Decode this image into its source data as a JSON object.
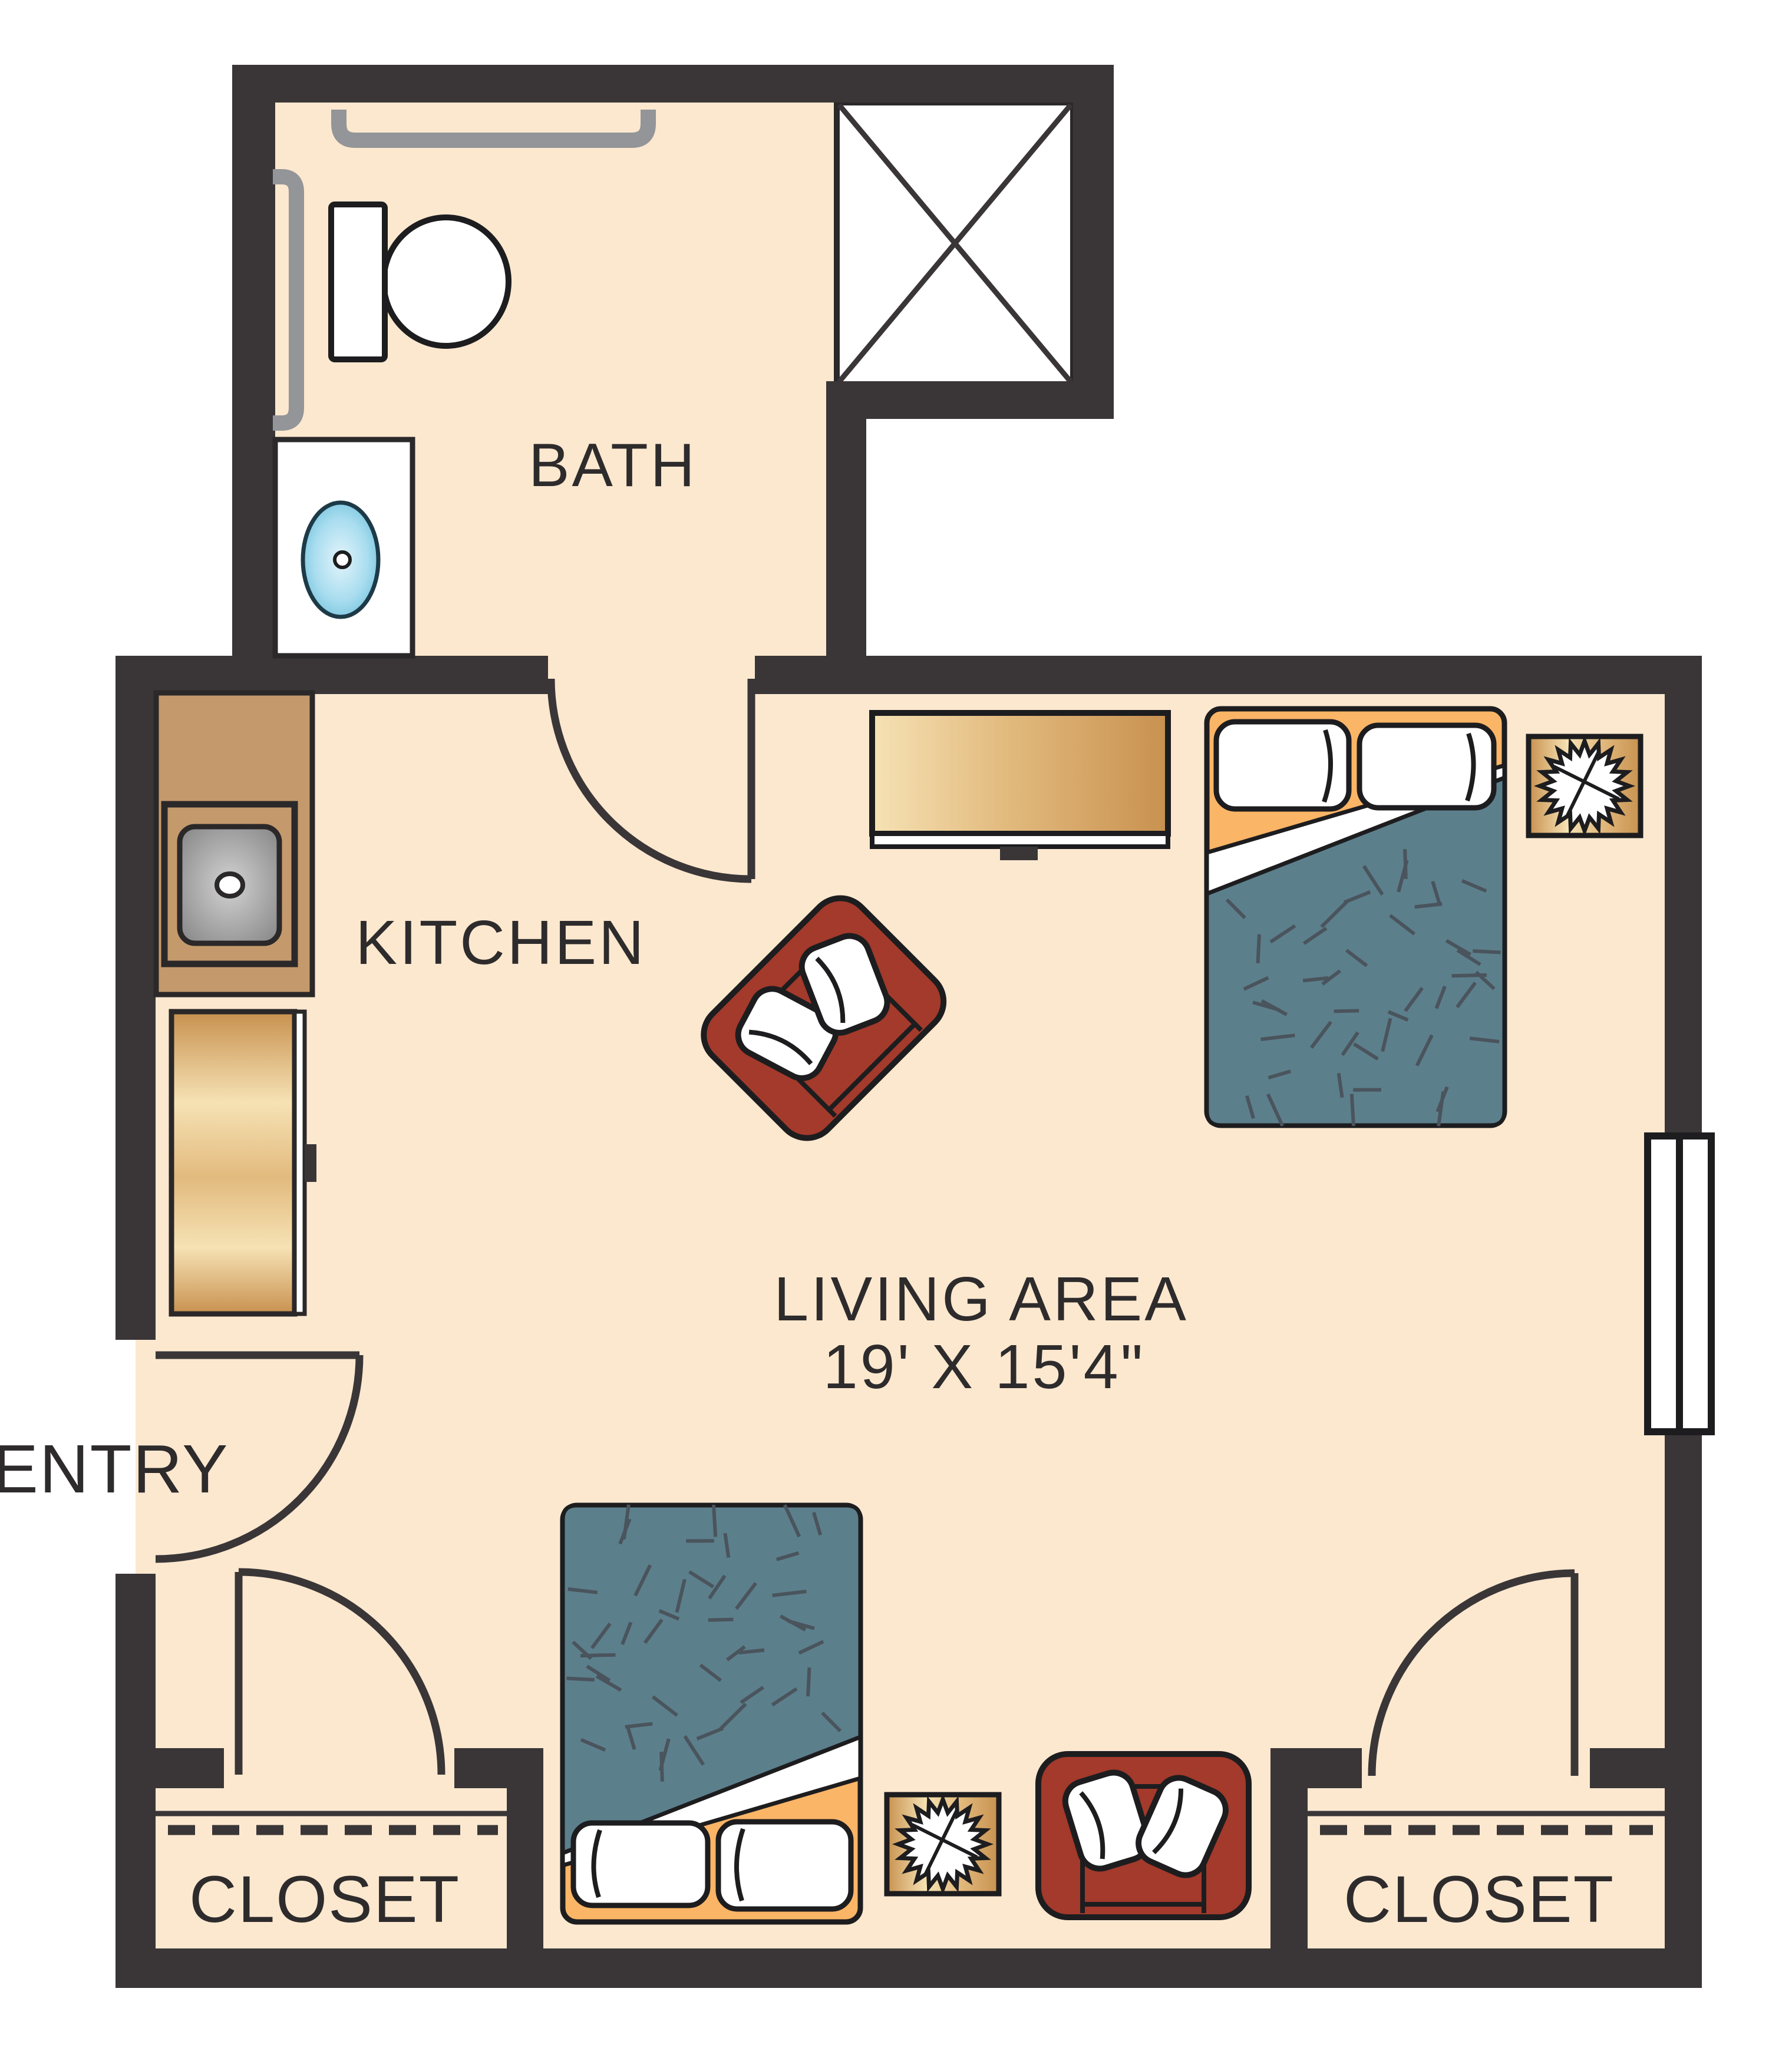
{
  "plan_title": "Studio apartment floor plan",
  "rooms": {
    "bath": {
      "label": "BATH"
    },
    "kitchen": {
      "label": "KITCHEN"
    },
    "living": {
      "label": "LIVING AREA",
      "dimensions": "19' X 15'4\""
    },
    "entry": {
      "label": "ENTRY"
    },
    "closet_left": {
      "label": "CLOSET"
    },
    "closet_right": {
      "label": "CLOSET"
    }
  },
  "icons": [
    "toilet-icon",
    "bath-sink-icon",
    "grab-bar-icon",
    "shower-icon",
    "kitchen-sink-icon",
    "refrigerator-icon",
    "tv-icon",
    "bed-icon",
    "pillow-icon",
    "nightstand-sunburst-icon",
    "armchair-icon",
    "window-icon",
    "door-swing-icon",
    "closet-rod-icon"
  ],
  "colors": {
    "wall": "#3a3637",
    "floor": "#fce8cf",
    "outline": "#1d1d1f",
    "blanket_teal": "#5c7f8c",
    "blanket_dash": "#4a545c",
    "mattress_orange": "#fbb566",
    "chair_red": "#a33a2b",
    "counter_brown": "#c49a6c",
    "grab_bar_gray": "#939598",
    "wood_light": "#f6e2b4",
    "wood_mid": "#e2ba7e",
    "wood_dark": "#c8914f",
    "sink_blue": "#7ac4de",
    "label_text": "#2e2b2c"
  }
}
